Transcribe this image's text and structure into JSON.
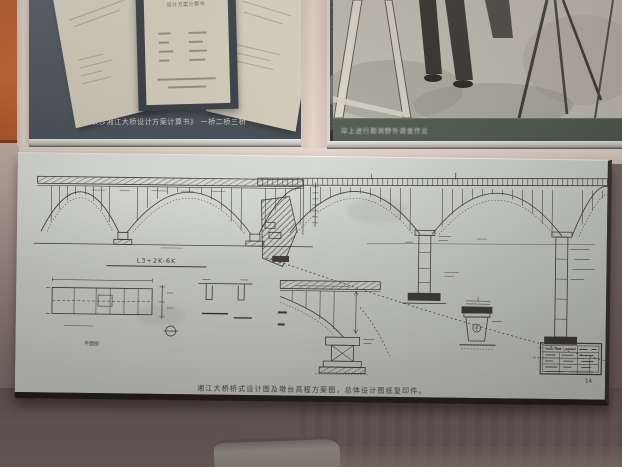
{
  "exhibit": {
    "top_left_panel": {
      "caption": "《长沙湘江大桥设计方案计算书》 一桥二桥三桥",
      "center_document_title": "设计方案计算书"
    },
    "top_right_panel": {
      "caption": "岸上进行勘测野外调查作业"
    },
    "blueprint_panel": {
      "caption": "湘江大桥桥式设计图及墩台高程方案图，总体设计图纸复印件。",
      "chainage_label": "L3+2K-6K",
      "plan_label": "平面图",
      "sheet_number": "14"
    },
    "colors": {
      "orange_panel": "#c4602e",
      "document_board": "#49525b",
      "photo_caption_bar": "#4d584c",
      "blueprint_paper": "#d8ddd6",
      "drawing_ink": "#3c3a33",
      "wall_divider": "#e6d8cd",
      "lower_wall": "#7b6b6a"
    }
  }
}
